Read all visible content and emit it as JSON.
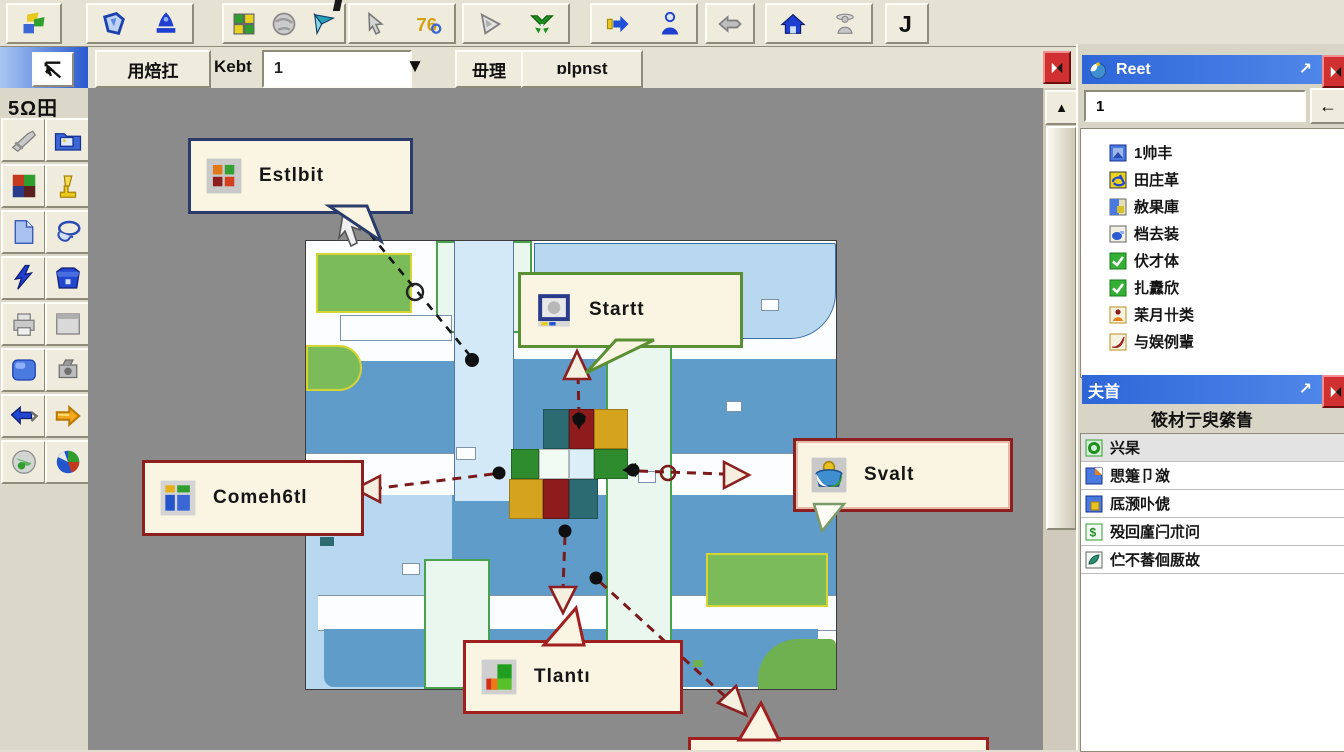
{
  "toolbar_primary": {
    "seventy_six_text": "76",
    "letter_j_text": "J",
    "buttons": [
      "layers-colorful",
      "polygon-blue",
      "bell-blue",
      "window-grid",
      "sphere-gray",
      "flag-teal",
      "cursor-arrow",
      "seventy-six",
      "pointer-triangle",
      "green-v-arrows",
      "arrow-right-blue",
      "person-blue",
      "arrow-left-gray",
      "home-blue",
      "statue-gray",
      "letter-j"
    ]
  },
  "toolbar_secondary": {
    "nav_button": "用焙扛",
    "field_label": "Kebt",
    "combo_value": "1",
    "manage_button": "毌理",
    "open_button": "ɒlpnst"
  },
  "sidebar": {
    "header": "5Ω田",
    "tools": [
      "pliers",
      "folder-image",
      "color-quad",
      "lamp-yellow",
      "page-blue",
      "lasso-blue",
      "lightning-blue",
      "box-blue",
      "printer-gray",
      "panel-gray",
      "rounded-blue",
      "camera-gray",
      "arrow-left-blue",
      "arrow-right-orange",
      "globe-gray",
      "pie-chart"
    ]
  },
  "canvas": {
    "callouts": {
      "estlbit": "Estlbit",
      "startt": "Startt",
      "svalt": "Svalt",
      "comeh6tl": "Comeh6tl",
      "tlanti": "Tlantı"
    },
    "center_grid": {
      "palette": {
        "teal": "#2d6b72",
        "darkred": "#8e1c1c",
        "gold": "#d6a31f",
        "green": "#2e8b2e",
        "white": "#f2faf4",
        "paleblue": "#dceef8"
      },
      "cells": [
        {
          "x": 237,
          "y": 168,
          "w": 26,
          "h": 40,
          "c": "teal"
        },
        {
          "x": 263,
          "y": 168,
          "w": 25,
          "h": 40,
          "c": "darkred"
        },
        {
          "x": 288,
          "y": 168,
          "w": 34,
          "h": 40,
          "c": "gold"
        },
        {
          "x": 205,
          "y": 208,
          "w": 28,
          "h": 30,
          "c": "green"
        },
        {
          "x": 233,
          "y": 208,
          "w": 30,
          "h": 30,
          "c": "white"
        },
        {
          "x": 263,
          "y": 208,
          "w": 25,
          "h": 30,
          "c": "paleblue"
        },
        {
          "x": 288,
          "y": 208,
          "w": 34,
          "h": 30,
          "c": "green"
        },
        {
          "x": 203,
          "y": 238,
          "w": 34,
          "h": 40,
          "c": "gold"
        },
        {
          "x": 237,
          "y": 238,
          "w": 26,
          "h": 40,
          "c": "darkred"
        },
        {
          "x": 263,
          "y": 238,
          "w": 29,
          "h": 40,
          "c": "teal"
        }
      ]
    }
  },
  "right_panel": {
    "layers_window": {
      "title": "Reet",
      "search_value": "1",
      "back_button": "←",
      "items": [
        {
          "icon": "layer-image-blue",
          "label": "1帅丰"
        },
        {
          "icon": "layer-refresh-yellow",
          "label": "田庄革"
        },
        {
          "icon": "layer-blue-yellow",
          "label": "赦果庫"
        },
        {
          "icon": "layer-blob-blue",
          "label": "档去装"
        },
        {
          "icon": "checkmark-green",
          "label": "伏才体"
        },
        {
          "icon": "checkmark-green",
          "label": "扎纛欣"
        },
        {
          "icon": "person-orange",
          "label": "苿月卄类"
        },
        {
          "icon": "swoosh-red",
          "label": "与娱例輩"
        }
      ]
    },
    "legend_window": {
      "title": "夫首",
      "header": "筱材亍臾綮眚",
      "items": [
        {
          "icon": "donut-green",
          "label": "兴杲"
        },
        {
          "icon": "page-blue-orange",
          "label": "愳箑卩潋"
        },
        {
          "icon": "square-blue-gold",
          "label": "厎滪卟俿"
        },
        {
          "icon": "symbol-green-dollar",
          "label": "殁回廑闩朮问"
        },
        {
          "icon": "leaf-teal",
          "label": "伫不萫佪厫故"
        }
      ]
    }
  }
}
